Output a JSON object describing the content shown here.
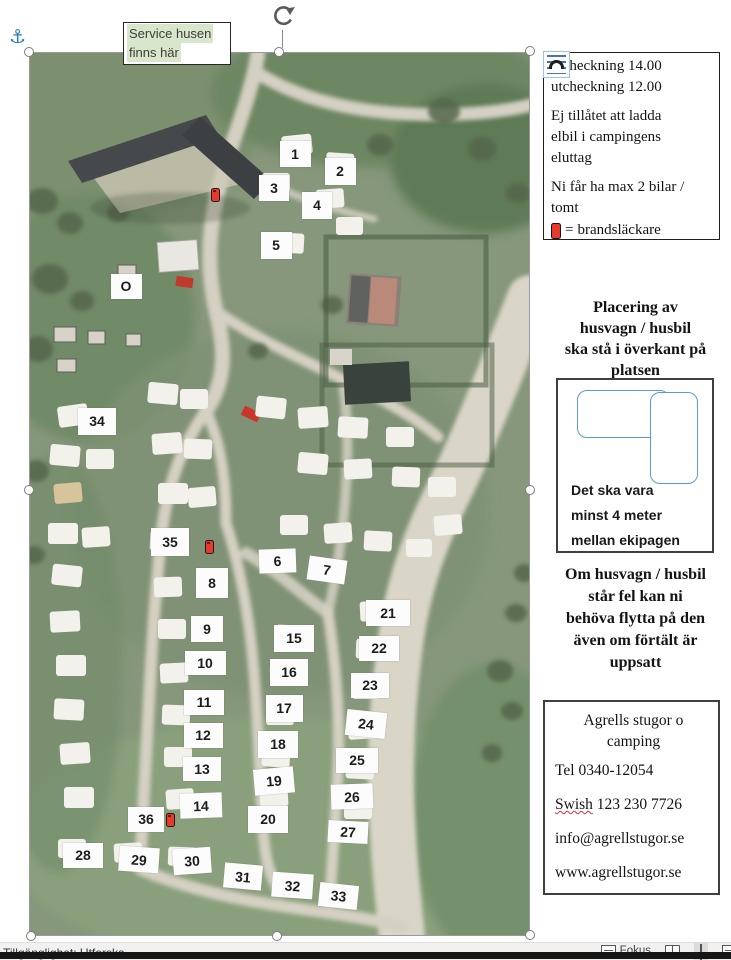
{
  "callout": {
    "line1": "Service husen",
    "line2": "finns här"
  },
  "info_box": {
    "checkin": "incheckning 14.00\nutcheckning 12.00",
    "rule_elbil": "Ej tillåtet att ladda\nelbil i campingens\neluttag",
    "rule_bilar": "Ni får ha max 2 bilar /\ntomt",
    "legend_eq": "=",
    "legend_label": "brandsläckare"
  },
  "placement_heading": "Placering av\nhusvagn / husbil\nska stå i överkant på\nplatsen",
  "diagram": {
    "note": "Det ska vara\nminst 4 meter\nmellan ekipagen"
  },
  "warning": "Om husvagn / husbil\nstår fel kan ni\nbehöva flytta på den\näven om förtält är\nuppsatt",
  "contact": {
    "name": "Agrells stugor o\ncamping",
    "tel": "Tel 0340-12054",
    "swish_word": "Swish",
    "swish_number": " 123 230 7726",
    "email": "info@agrellstugor.se",
    "web": "www.agrellstugor.se"
  },
  "statusbar": {
    "left": "Tillgänglighet: Utforska",
    "focus": "Fokus"
  },
  "colors": {
    "highlight_green": "#d8e6cb",
    "extinguisher_red": "#e8392e",
    "caravan_outline_blue": "#5b9bd5",
    "anchor_blue": "#2f7bbf"
  },
  "map": {
    "markers": [
      {
        "label": "1",
        "x": 265,
        "y": 101,
        "w": 31,
        "h": 26,
        "r": 0
      },
      {
        "label": "2",
        "x": 310,
        "y": 118,
        "w": 31,
        "h": 27,
        "r": 0
      },
      {
        "label": "3",
        "x": 244,
        "y": 135,
        "w": 30,
        "h": 26,
        "r": 0
      },
      {
        "label": "4",
        "x": 287,
        "y": 152,
        "w": 30,
        "h": 27,
        "r": 0
      },
      {
        "label": "5",
        "x": 246,
        "y": 192,
        "w": 31,
        "h": 27,
        "r": 0
      },
      {
        "label": "O",
        "x": 96,
        "y": 233,
        "w": 31,
        "h": 25,
        "r": 0
      },
      {
        "label": "34",
        "x": 67,
        "y": 368,
        "w": 38,
        "h": 27,
        "r": 0
      },
      {
        "label": "35",
        "x": 140,
        "y": 489,
        "w": 38,
        "h": 28,
        "r": 0
      },
      {
        "label": "8",
        "x": 182,
        "y": 530,
        "w": 32,
        "h": 30,
        "r": 0
      },
      {
        "label": "6",
        "x": 247,
        "y": 508,
        "w": 37,
        "h": 24,
        "r": -2
      },
      {
        "label": "7",
        "x": 297,
        "y": 517,
        "w": 38,
        "h": 24,
        "r": 8
      },
      {
        "label": "9",
        "x": 177,
        "y": 576,
        "w": 32,
        "h": 26,
        "r": 0
      },
      {
        "label": "10",
        "x": 175,
        "y": 610,
        "w": 41,
        "h": 24,
        "r": 0
      },
      {
        "label": "11",
        "x": 174,
        "y": 649,
        "w": 40,
        "h": 25,
        "r": 0
      },
      {
        "label": "12",
        "x": 173,
        "y": 682,
        "w": 39,
        "h": 25,
        "r": 0
      },
      {
        "label": "13",
        "x": 172,
        "y": 716,
        "w": 38,
        "h": 24,
        "r": 0
      },
      {
        "label": "14",
        "x": 171,
        "y": 752,
        "w": 42,
        "h": 25,
        "r": -2
      },
      {
        "label": "15",
        "x": 264,
        "y": 585,
        "w": 40,
        "h": 27,
        "r": 0
      },
      {
        "label": "16",
        "x": 259,
        "y": 619,
        "w": 38,
        "h": 27,
        "r": 0
      },
      {
        "label": "17",
        "x": 254,
        "y": 655,
        "w": 37,
        "h": 27,
        "r": 0
      },
      {
        "label": "18",
        "x": 248,
        "y": 691,
        "w": 40,
        "h": 27,
        "r": 0
      },
      {
        "label": "19",
        "x": 244,
        "y": 728,
        "w": 40,
        "h": 26,
        "r": -5
      },
      {
        "label": "20",
        "x": 238,
        "y": 766,
        "w": 40,
        "h": 27,
        "r": 0
      },
      {
        "label": "21",
        "x": 358,
        "y": 560,
        "w": 44,
        "h": 26,
        "r": 0
      },
      {
        "label": "22",
        "x": 349,
        "y": 595,
        "w": 40,
        "h": 25,
        "r": 0
      },
      {
        "label": "23",
        "x": 340,
        "y": 632,
        "w": 38,
        "h": 25,
        "r": 0
      },
      {
        "label": "24",
        "x": 336,
        "y": 671,
        "w": 40,
        "h": 26,
        "r": 6
      },
      {
        "label": "25",
        "x": 327,
        "y": 707,
        "w": 42,
        "h": 25,
        "r": 0
      },
      {
        "label": "26",
        "x": 322,
        "y": 743,
        "w": 42,
        "h": 25,
        "r": -2
      },
      {
        "label": "27",
        "x": 318,
        "y": 779,
        "w": 40,
        "h": 22,
        "r": 3
      },
      {
        "label": "36",
        "x": 116,
        "y": 766,
        "w": 36,
        "h": 25,
        "r": 0
      },
      {
        "label": "28",
        "x": 53,
        "y": 802,
        "w": 40,
        "h": 25,
        "r": 0
      },
      {
        "label": "29",
        "x": 109,
        "y": 806,
        "w": 40,
        "h": 25,
        "r": 4
      },
      {
        "label": "30",
        "x": 162,
        "y": 808,
        "w": 38,
        "h": 26,
        "r": -4
      },
      {
        "label": "31",
        "x": 213,
        "y": 823,
        "w": 38,
        "h": 25,
        "r": 5
      },
      {
        "label": "32",
        "x": 262,
        "y": 832,
        "w": 41,
        "h": 25,
        "r": 4
      },
      {
        "label": "33",
        "x": 308,
        "y": 843,
        "w": 39,
        "h": 24,
        "r": 6
      }
    ],
    "extinguishers": [
      {
        "x": 186,
        "y": 142
      },
      {
        "x": 180,
        "y": 494
      },
      {
        "x": 141,
        "y": 767
      }
    ]
  }
}
